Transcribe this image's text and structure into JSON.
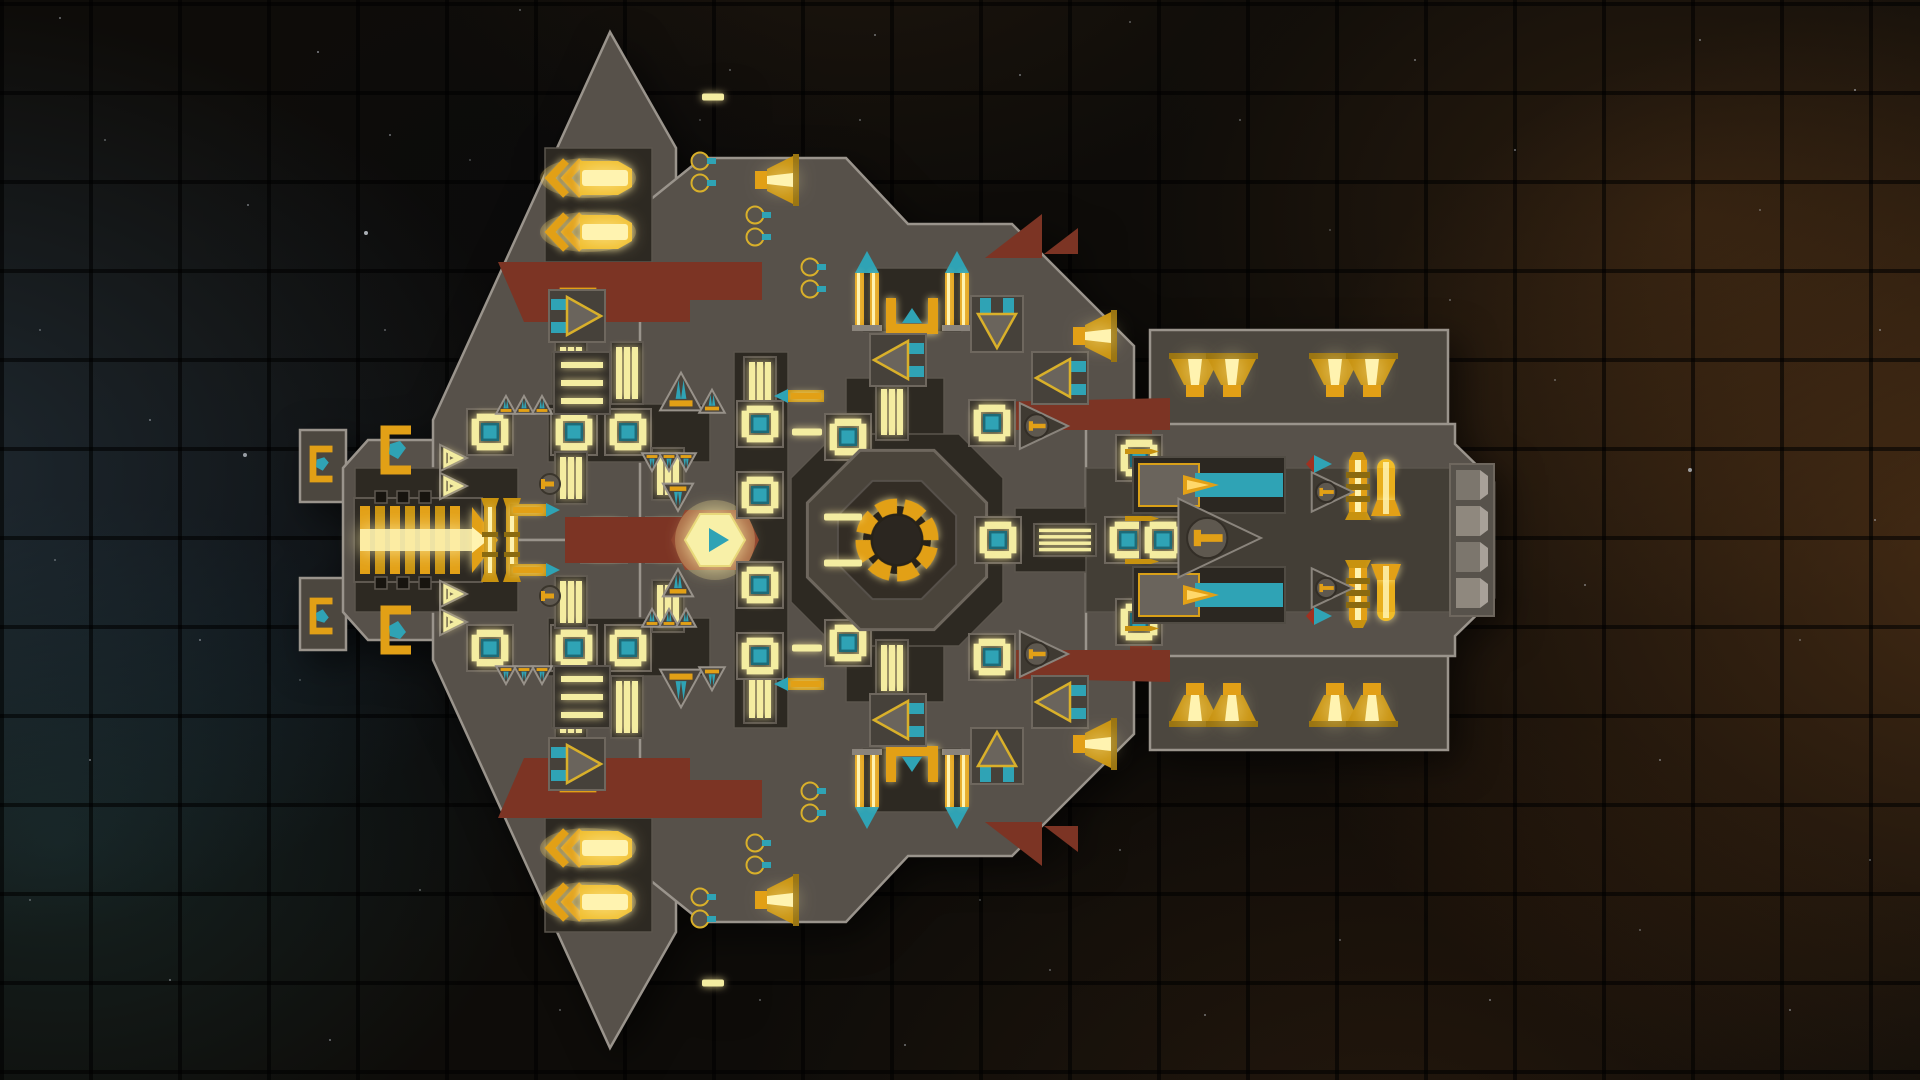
{
  "scene": {
    "view": "top-down-ship",
    "background": {
      "base_color": "#0e0c09",
      "grid_pitch": 89,
      "grid_line_color": "rgba(0,0,0,0.58)",
      "nebula_left_blue": "rgba(62,96,124,0.34)",
      "nebula_left_teal": "rgba(42,94,98,0.27)",
      "nebula_right_orange": "rgba(158,94,38,0.36)",
      "nebula_right_brown": "rgba(118,72,30,0.28)"
    },
    "stars": [
      [
        60,
        18,
        1,
        0.5
      ],
      [
        318,
        52,
        1,
        0.6
      ],
      [
        520,
        10,
        1,
        0.4
      ],
      [
        875,
        35,
        1,
        0.5
      ],
      [
        1130,
        22,
        1,
        0.4
      ],
      [
        1415,
        60,
        1,
        0.5
      ],
      [
        1700,
        40,
        1,
        0.5
      ],
      [
        1855,
        90,
        1,
        0.6
      ],
      [
        105,
        140,
        1,
        0.4
      ],
      [
        248,
        205,
        1,
        0.5
      ],
      [
        470,
        160,
        1,
        0.3
      ],
      [
        366,
        233,
        2,
        0.8
      ],
      [
        700,
        120,
        1,
        0.3
      ],
      [
        1515,
        150,
        1,
        0.5
      ],
      [
        1760,
        210,
        1,
        0.4
      ],
      [
        1880,
        330,
        1,
        0.5
      ],
      [
        40,
        330,
        1,
        0.4
      ],
      [
        150,
        420,
        1,
        0.5
      ],
      [
        55,
        560,
        1,
        0.4
      ],
      [
        200,
        640,
        1,
        0.5
      ],
      [
        90,
        760,
        1,
        0.5
      ],
      [
        30,
        900,
        1,
        0.4
      ],
      [
        170,
        980,
        1,
        0.5
      ],
      [
        330,
        1040,
        1,
        0.5
      ],
      [
        300,
        680,
        1,
        0.3
      ],
      [
        420,
        890,
        1,
        0.4
      ],
      [
        560,
        1010,
        1,
        0.4
      ],
      [
        640,
        950,
        1,
        0.3
      ],
      [
        760,
        1000,
        1,
        0.4
      ],
      [
        905,
        1045,
        1,
        0.5
      ],
      [
        1050,
        970,
        1,
        0.4
      ],
      [
        1205,
        1015,
        1,
        0.5
      ],
      [
        1340,
        940,
        1,
        0.4
      ],
      [
        1490,
        1000,
        1,
        0.5
      ],
      [
        1640,
        930,
        1,
        0.4
      ],
      [
        1790,
        1010,
        1,
        0.5
      ],
      [
        1870,
        860,
        1,
        0.4
      ],
      [
        1660,
        760,
        1,
        0.5
      ],
      [
        1800,
        640,
        1,
        0.4
      ],
      [
        1875,
        520,
        1,
        0.5
      ],
      [
        1690,
        470,
        2,
        0.7
      ],
      [
        1555,
        380,
        1,
        0.4
      ],
      [
        1240,
        120,
        1,
        0.4
      ],
      [
        1020,
        75,
        1,
        0.5
      ],
      [
        1330,
        230,
        1,
        0.3
      ],
      [
        1450,
        300,
        1,
        0.4
      ],
      [
        245,
        455,
        2,
        0.7
      ],
      [
        385,
        330,
        1,
        0.4
      ],
      [
        520,
        720,
        1,
        0.4
      ],
      [
        1120,
        850,
        1,
        0.4
      ],
      [
        980,
        900,
        1,
        0.3
      ],
      [
        860,
        120,
        1,
        0.4
      ],
      [
        1585,
        585,
        1,
        0.5
      ],
      [
        1025,
        640,
        1,
        0.6
      ],
      [
        1330,
        700,
        1,
        0.4
      ],
      [
        1180,
        330,
        1,
        0.4
      ],
      [
        730,
        70,
        1,
        0.4
      ],
      [
        390,
        135,
        1,
        0.5
      ]
    ]
  },
  "palette": {
    "hull": "#57514a",
    "hull2": "#4c473f",
    "dark": "#2d2922",
    "dark2": "#433e36",
    "edge": "#9a948c",
    "edge2": "#6e675e",
    "red": "#7c3424",
    "gold": "#e2a016",
    "gold2": "#c8920f",
    "bright": "#fff3b0",
    "pale": "#f4eda1",
    "teal": "#2fa3b5",
    "glow": "#ffe98e"
  },
  "ship": {
    "centerline_y": 540,
    "hull": [
      {
        "pts": "300,430 346,430 346,502 300,502",
        "f": "hull2",
        "m": 1
      },
      {
        "pts": "343,468 368,440 480,440 480,414 522,414 522,666 480,666 480,640 368,640 343,612",
        "f": "hull"
      },
      {
        "pts": "433,420 610,32 676,148 676,540 433,540",
        "f": "hull",
        "m": 1
      },
      {
        "pts": "640,208 702,158 846,158 908,224 1012,224 1088,300 1134,346 1134,734 1088,780 1012,856 908,856 846,922 702,922 640,872",
        "f": "hull"
      },
      {
        "pts": "1150,330 1448,330 1448,428 1150,428",
        "f": "hull2",
        "m": 1
      },
      {
        "pts": "1086,424 1455,424 1455,444 1494,482 1494,598 1455,636 1455,656 1086,656",
        "f": "hull"
      }
    ],
    "dark_zones": [
      {
        "pts": "355,468 518,468 518,612 355,612"
      },
      {
        "pts": "545,148 652,148 652,262 545,262",
        "m": 1
      },
      {
        "pts": "552,352 614,352 614,416 552,416",
        "m": 1
      },
      {
        "pts": "548,404 710,404 710,462 548,462",
        "m": 1
      },
      {
        "pts": "734,352 788,352 788,728 734,728"
      },
      {
        "pts": "846,378 944,378 944,452 846,452",
        "m": 1
      },
      {
        "pts": "862,268 962,268 962,332 862,332",
        "m": 1
      },
      {
        "pts": "791,478 835,434 959,434 1003,478 1003,602 959,646 835,646 791,602",
        "e": 1
      },
      {
        "pts": "1015,508 1192,508 1192,572 1015,572"
      },
      {
        "pts": "1086,468 1456,468 1456,612 1086,612",
        "f2": 1
      }
    ],
    "red_accents": [
      {
        "pts": "498,262 762,262 762,300 690,300 690,322 524,322",
        "m": 1
      },
      {
        "pts": "988,402 1170,398 1170,430 1152,430 1152,468 1130,468 1130,430 988,430",
        "m": 1
      },
      {
        "pts": "985,258 1042,214 1042,258",
        "m": 1
      },
      {
        "pts": "1044,254 1078,228 1078,254",
        "m": 1
      },
      {
        "pts": "565,517 695,517 695,563 565,563"
      }
    ],
    "modules": [
      {
        "t": "engine",
        "x": 418,
        "y": 540
      },
      {
        "t": "goldcol",
        "x": 501,
        "y": 540
      },
      {
        "t": "pent",
        "x": 397,
        "y": 450,
        "m": 1
      },
      {
        "t": "pent",
        "x": 322,
        "y": 464,
        "m": 1,
        "s": 0.75
      },
      {
        "t": "pent",
        "x": 578,
        "y": 300,
        "m": 1,
        "s": 0.75,
        "r": 90
      },
      {
        "t": "winrow",
        "x": 403,
        "y": 497,
        "m": 1
      },
      {
        "t": "vent",
        "x": 452,
        "y": 458,
        "m": 1,
        "s": 24
      },
      {
        "t": "vent",
        "x": 452,
        "y": 486,
        "m": 1,
        "s": 24
      },
      {
        "t": "room",
        "x": 490,
        "y": 432,
        "m": 1
      },
      {
        "t": "room",
        "x": 574,
        "y": 432,
        "m": 1
      },
      {
        "t": "room",
        "x": 628,
        "y": 432,
        "m": 1
      },
      {
        "t": "corV",
        "x": 571,
        "y": 373,
        "m": 1,
        "h": 62
      },
      {
        "t": "corV",
        "x": 627,
        "y": 373,
        "m": 1,
        "h": 62
      },
      {
        "t": "corV",
        "x": 571,
        "y": 478,
        "m": 1,
        "h": 52
      },
      {
        "t": "corV",
        "x": 668,
        "y": 474,
        "m": 1,
        "h": 52
      },
      {
        "t": "thr",
        "x": 681,
        "y": 396,
        "m": 1,
        "s": 36
      },
      {
        "t": "thr",
        "x": 712,
        "y": 404,
        "m": 1,
        "s": 22
      },
      {
        "t": "thr",
        "x": 506,
        "y": 407,
        "m": 1,
        "s": 17
      },
      {
        "t": "thr",
        "x": 524,
        "y": 407,
        "m": 1,
        "s": 17
      },
      {
        "t": "thr",
        "x": 542,
        "y": 407,
        "m": 1,
        "s": 17
      },
      {
        "t": "thr",
        "x": 652,
        "y": 460,
        "r": 180,
        "m": 1,
        "s": 17
      },
      {
        "t": "thr",
        "x": 669,
        "y": 460,
        "r": 180,
        "m": 1,
        "s": 17
      },
      {
        "t": "thr",
        "x": 686,
        "y": 460,
        "r": 180,
        "m": 1,
        "s": 17
      },
      {
        "t": "thr",
        "x": 678,
        "y": 494,
        "r": 180,
        "m": 1,
        "s": 26
      },
      {
        "t": "smalltorp",
        "x": 534,
        "y": 510,
        "m": 1
      },
      {
        "t": "dome0",
        "x": 550,
        "y": 484,
        "m": 1
      },
      {
        "t": "room",
        "x": 604,
        "y": 540
      },
      {
        "t": "room",
        "x": 669,
        "y": 540
      },
      {
        "t": "hex",
        "x": 715,
        "y": 540
      },
      {
        "t": "corV",
        "x": 760,
        "y": 384,
        "m": 1,
        "h": 54
      },
      {
        "t": "room",
        "x": 760,
        "y": 424,
        "m": 1
      },
      {
        "t": "room",
        "x": 760,
        "y": 495,
        "m": 1
      },
      {
        "t": "smalltorp",
        "x": 800,
        "y": 396,
        "r": 180,
        "m": 1
      },
      {
        "t": "glowbar",
        "x": 807,
        "y": 432,
        "m": 1,
        "w": 30
      },
      {
        "t": "room",
        "x": 848,
        "y": 437,
        "m": 1
      },
      {
        "t": "corV",
        "x": 892,
        "y": 412,
        "m": 1,
        "h": 56
      },
      {
        "t": "reactor",
        "x": 897,
        "y": 540
      },
      {
        "t": "glowbar",
        "x": 843,
        "y": 517,
        "m": 1,
        "w": 38
      },
      {
        "t": "room",
        "x": 998,
        "y": 540
      },
      {
        "t": "corH",
        "x": 1065,
        "y": 540,
        "w": 62,
        "n": 4
      },
      {
        "t": "room",
        "x": 1128,
        "y": 540
      },
      {
        "t": "room",
        "x": 1163,
        "y": 540
      },
      {
        "t": "room",
        "x": 992,
        "y": 423,
        "m": 1
      },
      {
        "t": "room",
        "x": 1139,
        "y": 458,
        "m": 1
      },
      {
        "t": "tower",
        "x": 867,
        "y": 299,
        "m": 1
      },
      {
        "t": "tower",
        "x": 957,
        "y": 299,
        "m": 1
      },
      {
        "t": "ubracket",
        "x": 912,
        "y": 316,
        "m": 1
      },
      {
        "t": "turret",
        "x": 898,
        "y": 360,
        "m": 1
      },
      {
        "t": "turret",
        "x": 997,
        "y": 324,
        "m": 1,
        "r": -90
      },
      {
        "t": "turret",
        "x": 1060,
        "y": 378,
        "m": 1
      },
      {
        "t": "turret",
        "x": 577,
        "y": 316,
        "m": 1,
        "r": 180
      },
      {
        "t": "ladder",
        "x": 582,
        "y": 383,
        "m": 1
      },
      {
        "t": "launcher",
        "x": 592,
        "y": 178,
        "m": 1
      },
      {
        "t": "launcher",
        "x": 592,
        "y": 232,
        "m": 1
      },
      {
        "t": "trumpet",
        "x": 772,
        "y": 180,
        "m": 1,
        "r": 90
      },
      {
        "t": "portpair",
        "x": 700,
        "y": 172,
        "m": 1
      },
      {
        "t": "portpair",
        "x": 755,
        "y": 226,
        "m": 1
      },
      {
        "t": "portpair",
        "x": 810,
        "y": 278,
        "m": 1
      },
      {
        "t": "cannon",
        "x": 1209,
        "y": 485,
        "m": 1
      },
      {
        "t": "screw",
        "x": 1358,
        "y": 486,
        "m": 1
      },
      {
        "t": "belltorp",
        "x": 1386,
        "y": 486,
        "m": 1
      },
      {
        "t": "tealtip",
        "x": 1322,
        "y": 464,
        "m": 1
      },
      {
        "t": "dometri",
        "x": 1213,
        "y": 538,
        "s": 48
      },
      {
        "t": "dometri",
        "x": 1040,
        "y": 426,
        "m": 1,
        "s": 28
      },
      {
        "t": "dometri",
        "x": 1329,
        "y": 492,
        "m": 1,
        "s": 24
      },
      {
        "t": "trumpet",
        "x": 1195,
        "y": 380,
        "m": 1
      },
      {
        "t": "trumpet",
        "x": 1232,
        "y": 380,
        "m": 1
      },
      {
        "t": "trumpet",
        "x": 1335,
        "y": 380,
        "m": 1
      },
      {
        "t": "trumpet",
        "x": 1372,
        "y": 380,
        "m": 1
      },
      {
        "t": "trumpet",
        "x": 1090,
        "y": 336,
        "m": 1,
        "r": 90
      },
      {
        "t": "armor",
        "x": 1472,
        "y": 540
      },
      {
        "t": "glowbar",
        "x": 713,
        "y": 97,
        "m": 1,
        "w": 22
      }
    ]
  }
}
